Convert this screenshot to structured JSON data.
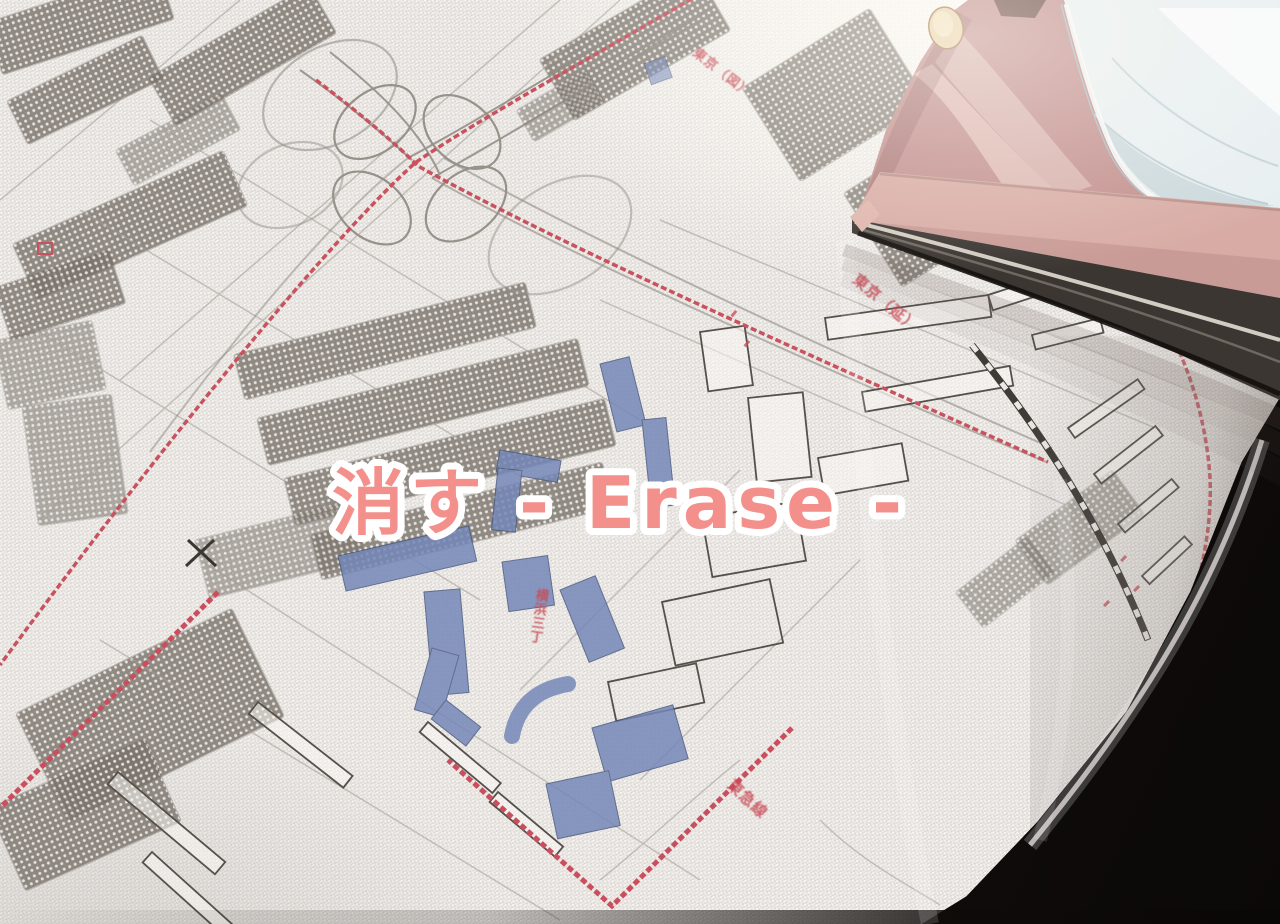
{
  "overlay": {
    "title": "消す - Erase -",
    "text_color": "#f4908c",
    "outline_color": "#ffffff"
  },
  "map": {
    "labels": [
      {
        "text": "東京（図）"
      },
      {
        "text": "東京（延）"
      },
      {
        "text": "横浜三丁"
      },
      {
        "text": "東急線"
      }
    ],
    "colors": {
      "road_red": "#c8525e",
      "building_blue": "#7487b8",
      "block_gray": "#7c766e",
      "line_gray": "#8d8780"
    }
  },
  "iron": {
    "colors": {
      "body": "#c28f8d",
      "skirt": "#d8aca5",
      "tank": "#e8eff1",
      "soleplate": "#3b3632",
      "button": "#e9d3a9"
    }
  },
  "background": {
    "fabric": "#e8e4e0",
    "shadow_corner": "#14100e"
  }
}
